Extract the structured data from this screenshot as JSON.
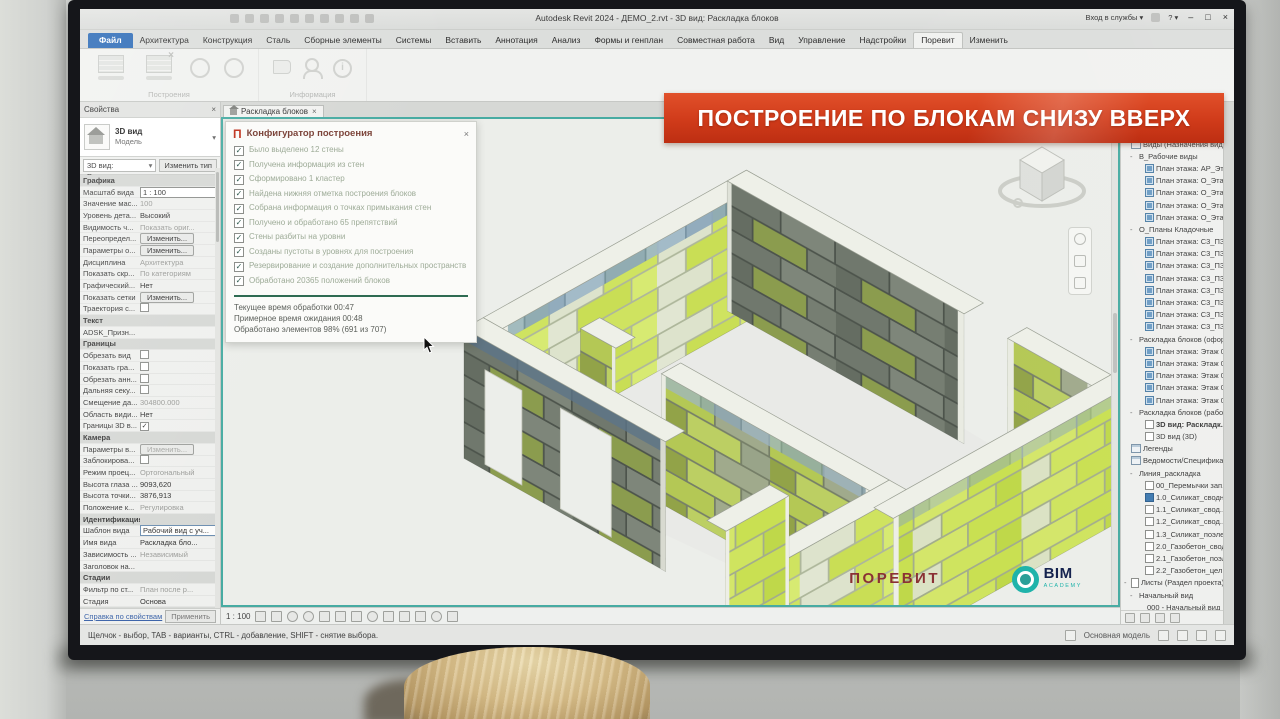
{
  "window": {
    "title": "Autodesk Revit 2024 - ДЕМО_2.rvt - 3D вид: Раскладка блоков",
    "signin": "Вход в службы ▾",
    "help": "? ▾",
    "min": "–",
    "max": "□",
    "close": "×"
  },
  "ribbon": {
    "tabs": [
      {
        "label": "Файл",
        "cls": "file"
      },
      {
        "label": "Архитектура"
      },
      {
        "label": "Конструкция"
      },
      {
        "label": "Сталь"
      },
      {
        "label": "Сборные элементы"
      },
      {
        "label": "Системы"
      },
      {
        "label": "Вставить"
      },
      {
        "label": "Аннотация"
      },
      {
        "label": "Анализ"
      },
      {
        "label": "Формы и генплан"
      },
      {
        "label": "Совместная работа"
      },
      {
        "label": "Вид"
      },
      {
        "label": "Управление"
      },
      {
        "label": "Надстройки"
      },
      {
        "label": "Поревит",
        "cls": "active"
      },
      {
        "label": "Изменить"
      }
    ],
    "overflow": "ⓘ ▾",
    "panel_build": "Построения",
    "panel_info": "Информация"
  },
  "banner": {
    "text": "ПОСТРОЕНИЕ ПО БЛОКАМ СНИЗУ ВВЕРХ"
  },
  "props": {
    "title": "Свойства",
    "close": "×",
    "type_name": "3D вид",
    "type_family": "Модель",
    "selector": "3D вид: Расклад...",
    "selector_arrow": "▾",
    "edit_type": "Изменить тип",
    "rows": [
      {
        "cls": "sec",
        "label": "Графика",
        "value": "",
        "vcls": ""
      },
      {
        "label": "Масштаб вида",
        "value": "1 : 100",
        "vcls": "box"
      },
      {
        "label": "Значение мас...",
        "value": "100",
        "vcls": "dim"
      },
      {
        "label": "Уровень дета...",
        "value": "Высокий",
        "vcls": ""
      },
      {
        "label": "Видимость ч...",
        "value": "Показать ориг...",
        "vcls": "dim"
      },
      {
        "label": "Переопредел...",
        "value": "Изменить...",
        "vcls": "btn"
      },
      {
        "label": "Параметры о...",
        "value": "Изменить...",
        "vcls": "btn"
      },
      {
        "label": "Дисциплина",
        "value": "Архитектура",
        "vcls": "dim"
      },
      {
        "label": "Показать скр...",
        "value": "По категориям",
        "vcls": "dim"
      },
      {
        "label": "Графический...",
        "value": "Нет",
        "vcls": ""
      },
      {
        "label": "Показать сетки",
        "value": "Изменить...",
        "vcls": "btn"
      },
      {
        "label": "Траектория с...",
        "value": "",
        "vcls": "chk0"
      },
      {
        "cls": "sec",
        "label": "Текст",
        "value": "",
        "vcls": ""
      },
      {
        "label": "ADSK_Призн...",
        "value": "",
        "vcls": "dim"
      },
      {
        "cls": "sec",
        "label": "Границы",
        "value": "",
        "vcls": ""
      },
      {
        "label": "Обрезать вид",
        "value": "",
        "vcls": "chk0"
      },
      {
        "label": "Показать гра...",
        "value": "",
        "vcls": "chk0"
      },
      {
        "label": "Обрезать анн...",
        "value": "",
        "vcls": "chk0"
      },
      {
        "label": "Дальняя секу...",
        "value": "",
        "vcls": "chk0"
      },
      {
        "label": "Смещение да...",
        "value": "304800.000",
        "vcls": "dim"
      },
      {
        "label": "Область види...",
        "value": "Нет",
        "vcls": ""
      },
      {
        "label": "Границы 3D в...",
        "value": "",
        "vcls": "chk1"
      },
      {
        "cls": "sec",
        "label": "Камера",
        "value": "",
        "vcls": ""
      },
      {
        "label": "Параметры в...",
        "value": "Изменить...",
        "vcls": "btn dim"
      },
      {
        "label": "Заблокирова...",
        "value": "",
        "vcls": "chk0"
      },
      {
        "label": "Режим проец...",
        "value": "Ортогональный",
        "vcls": "dim"
      },
      {
        "label": "Высота глаза ...",
        "value": "9093,620",
        "vcls": ""
      },
      {
        "label": "Высота точки...",
        "value": "3876,913",
        "vcls": ""
      },
      {
        "label": "Положение к...",
        "value": "Регулировка",
        "vcls": "dim"
      },
      {
        "cls": "sec",
        "label": "Идентификация",
        "value": "",
        "vcls": ""
      },
      {
        "label": "Шаблон вида",
        "value": "Рабочий вид с уч...",
        "vcls": "boxsel"
      },
      {
        "label": "Имя вида",
        "value": "Раскладка бло...",
        "vcls": ""
      },
      {
        "label": "Зависимость ...",
        "value": "Независимый",
        "vcls": "dim"
      },
      {
        "label": "Заголовок на...",
        "value": "",
        "vcls": ""
      },
      {
        "cls": "sec",
        "label": "Стадии",
        "value": "",
        "vcls": ""
      },
      {
        "label": "Фильтр по ст...",
        "value": "План после р...",
        "vcls": "dim"
      },
      {
        "label": "Стадия",
        "value": "Основа",
        "vcls": ""
      },
      {
        "cls": "sec",
        "label": "Общие",
        "value": "",
        "vcls": ""
      },
      {
        "label": "ADSK_Штамп ...",
        "value": "",
        "vcls": "dim"
      },
      {
        "cls": "sec",
        "label": "Данные",
        "value": "",
        "vcls": ""
      },
      {
        "label": "ADSK_Владел...",
        "value": "",
        "vcls": "dim"
      }
    ],
    "help_link": "Справка по свойствам",
    "apply": "Применить"
  },
  "viewtab": {
    "label": "Раскладка блоков",
    "close": "×"
  },
  "dialog": {
    "logo": "П",
    "title": "Конфигуратор построения",
    "close": "×",
    "items": [
      {
        "label": "Было выделено 12 стены"
      },
      {
        "label": "Получена информация из стен"
      },
      {
        "label": "Сформировано 1 кластер"
      },
      {
        "label": "Найдена нижняя отметка построения блоков"
      },
      {
        "label": "Собрана информация о точках примыкания стен"
      },
      {
        "label": "Получено и обработано 65 препятствий"
      },
      {
        "label": "Стены разбиты на уровни"
      },
      {
        "label": "Созданы пустоты в уровнях для построения"
      },
      {
        "label": "Резервирование и создание дополнительных пространств"
      },
      {
        "label": "Обработано 20365 положений блоков"
      }
    ],
    "footer": [
      {
        "line": "Текущее время обработки 00:47"
      },
      {
        "line": "Примерное время ожидания 00:48"
      },
      {
        "line": "Обработано элементов  98% (691 из 707)"
      }
    ]
  },
  "browser": {
    "title": "Диспетчер проекта - ДЕМО_2...",
    "close": "×",
    "search_placeholder": "Поиск",
    "rows": [
      {
        "cls": "lv0",
        "exp": "",
        "ico": "cat",
        "label": "Виды (Назначения видов)"
      },
      {
        "cls": "lv1",
        "exp": "-",
        "ico": "",
        "label": "В_Рабочие виды"
      },
      {
        "cls": "lv2",
        "exp": "",
        "ico": "v",
        "label": "План этажа: АР_Эта..."
      },
      {
        "cls": "lv2",
        "exp": "",
        "ico": "v",
        "label": "План этажа: О_Эта..."
      },
      {
        "cls": "lv2",
        "exp": "",
        "ico": "v",
        "label": "План этажа: О_Эта..."
      },
      {
        "cls": "lv2",
        "exp": "",
        "ico": "v",
        "label": "План этажа: О_Эта..."
      },
      {
        "cls": "lv2",
        "exp": "",
        "ico": "v",
        "label": "План этажа: О_Эта..."
      },
      {
        "cls": "lv1",
        "exp": "-",
        "ico": "",
        "label": "О_Планы Кладочные"
      },
      {
        "cls": "lv2",
        "exp": "",
        "ico": "v",
        "label": "План этажа: С3_ПЗ..."
      },
      {
        "cls": "lv2",
        "exp": "",
        "ico": "v",
        "label": "План этажа: С3_ПЗ..."
      },
      {
        "cls": "lv2",
        "exp": "",
        "ico": "v",
        "label": "План этажа: С3_ПЗ..."
      },
      {
        "cls": "lv2",
        "exp": "",
        "ico": "v",
        "label": "План этажа: С3_ПЗ..."
      },
      {
        "cls": "lv2",
        "exp": "",
        "ico": "v",
        "label": "План этажа: С3_ПЗ..."
      },
      {
        "cls": "lv2",
        "exp": "",
        "ico": "v",
        "label": "План этажа: С3_ПЗ..."
      },
      {
        "cls": "lv2",
        "exp": "",
        "ico": "v",
        "label": "План этажа: С3_ПЗ..."
      },
      {
        "cls": "lv2",
        "exp": "",
        "ico": "v",
        "label": "План этажа: С3_ПЗ..."
      },
      {
        "cls": "lv1",
        "exp": "-",
        "ico": "",
        "label": "Раскладка блоков (офор..."
      },
      {
        "cls": "lv2",
        "exp": "",
        "ico": "v",
        "label": "План этажа: Этаж 0..."
      },
      {
        "cls": "lv2",
        "exp": "",
        "ico": "v",
        "label": "План этажа: Этаж 0..."
      },
      {
        "cls": "lv2",
        "exp": "",
        "ico": "v",
        "label": "План этажа: Этаж 0..."
      },
      {
        "cls": "lv2",
        "exp": "",
        "ico": "v",
        "label": "План этажа: Этаж 0..."
      },
      {
        "cls": "lv2",
        "exp": "",
        "ico": "v",
        "label": "План этажа: Этаж 0..."
      },
      {
        "cls": "lv1",
        "exp": "-",
        "ico": "",
        "label": "Раскладка блоков (рабо..."
      },
      {
        "cls": "lv2 cur",
        "exp": "",
        "ico": "w",
        "label": "3D вид: Раскладк..."
      },
      {
        "cls": "lv2",
        "exp": "",
        "ico": "w",
        "label": "3D вид (3D)"
      },
      {
        "cls": "lv0",
        "exp": "",
        "ico": "cat",
        "label": "Легенды"
      },
      {
        "cls": "lv0",
        "exp": "",
        "ico": "cat",
        "label": "Ведомости/Специфика..."
      },
      {
        "cls": "lv1",
        "exp": "-",
        "ico": "",
        "label": "Линия_раскладка"
      },
      {
        "cls": "lv2",
        "exp": "",
        "ico": "w",
        "label": "00_Перемычки зап..."
      },
      {
        "cls": "lv2",
        "exp": "",
        "ico": "ws",
        "label": "1.0_Силикат_сводн..."
      },
      {
        "cls": "lv2",
        "exp": "",
        "ico": "w",
        "label": "1.1_Силикат_свод..."
      },
      {
        "cls": "lv2",
        "exp": "",
        "ico": "w",
        "label": "1.2_Силикат_свод..."
      },
      {
        "cls": "lv2",
        "exp": "",
        "ico": "w",
        "label": "1.3_Силикат_поэле..."
      },
      {
        "cls": "lv2",
        "exp": "",
        "ico": "w",
        "label": "2.0_Газобетон_свод..."
      },
      {
        "cls": "lv2",
        "exp": "",
        "ico": "w",
        "label": "2.1_Газобетон_поэл..."
      },
      {
        "cls": "lv2",
        "exp": "",
        "ico": "w",
        "label": "2.2_Газобетон_цел..."
      },
      {
        "cls": "lv0",
        "exp": "-",
        "ico": "sheet",
        "label": "Листы (Раздел проекта)"
      },
      {
        "cls": "lv1",
        "exp": "-",
        "ico": "",
        "label": "Начальный вид"
      },
      {
        "cls": "lv2",
        "exp": "",
        "ico": "",
        "label": "000 - Начальный вид"
      }
    ]
  },
  "viewcontrols": {
    "scale": "1 : 100"
  },
  "statusbar": {
    "hint": "Щелчок - выбор, TAB - варианты, CTRL - добавление, SHIFT - снятие выбора.",
    "model": "Основная модель"
  },
  "logos": {
    "porevit": "ПОРЕВИТ",
    "bim": "BIM",
    "academy": "ACADEMY"
  },
  "colors": {
    "banner_red": "#d03b1a",
    "viewport_teal": "#47aba2",
    "block_green": "#cfe360",
    "porevit_red": "#8a3134",
    "bim_navy": "#14224e",
    "bim_teal": "#1fb3aa"
  }
}
